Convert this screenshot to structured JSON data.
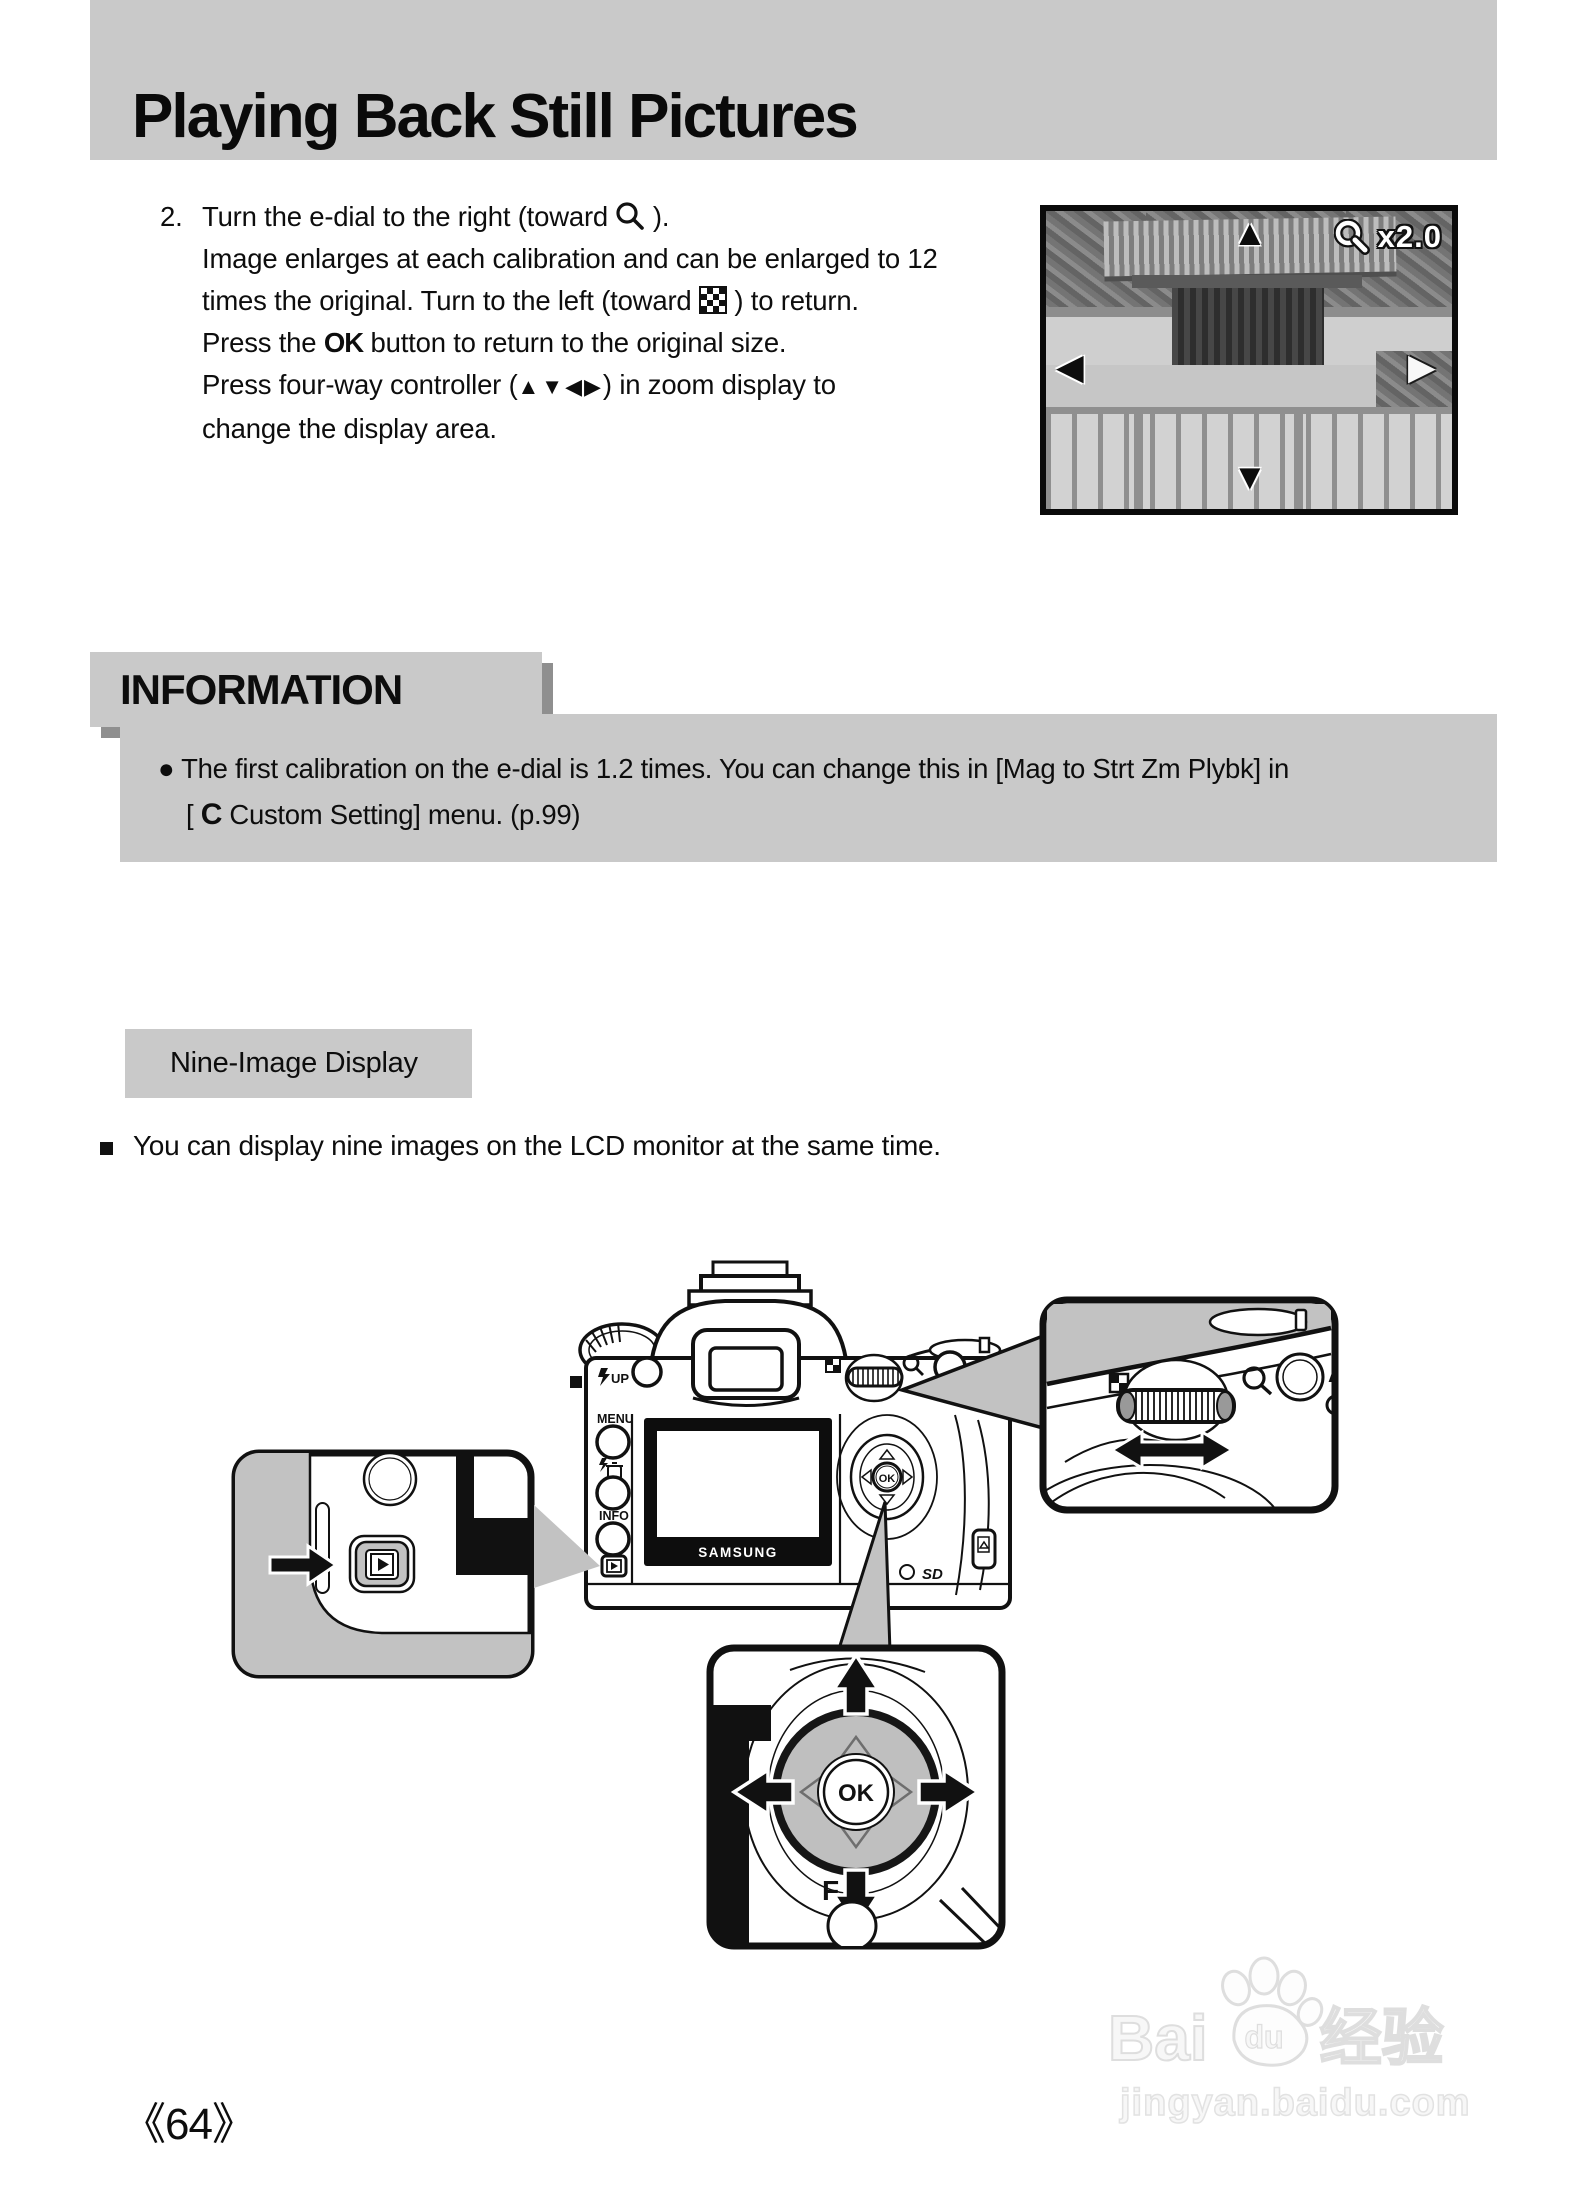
{
  "page": {
    "title": "Playing Back Still Pictures",
    "page_number": "《64》"
  },
  "instruction": {
    "number": "2.",
    "line1_pre": "Turn the e-dial to the right (toward",
    "line1_post": ").",
    "line2": "Image enlarges at each calibration and can be enlarged to 12",
    "line3_pre": "times the original. Turn to the left (toward",
    "line3_post": ") to return.",
    "line4_pre": "Press the",
    "line4_ok": "OK",
    "line4_post": "button to return to the original size.",
    "line5_pre": "Press four-way controller (",
    "line5_arrows": "▲▼◀▶",
    "line5_post": ") in zoom display to",
    "line6": "change the display area."
  },
  "lcd_preview": {
    "zoom_label": "x2.0",
    "arrow_up": "▲",
    "arrow_down": "▼",
    "arrow_left": "◀",
    "arrow_right": "▶"
  },
  "information": {
    "heading": "INFORMATION",
    "bullet": "●",
    "line1": "The first calibration on the e-dial is 1.2 times. You can change this in [Mag to Strt Zm Plybk] in",
    "line2_open": "[",
    "line2_c": "C",
    "line2_rest": "Custom Setting] menu. (p.99)"
  },
  "nine_image": {
    "label": "Nine-Image Display",
    "bullet_text": "You can display nine images on the LCD monitor at the same time."
  },
  "diagram": {
    "flash_up_label": "UP",
    "menu_label": "MENU",
    "info_label": "INFO",
    "ae_lock_label": "AE-L",
    "brand_label": "SAMSUNG",
    "ok_label": "OK",
    "ok_big_label": "OK",
    "sd_label": "SD",
    "fn_label": "F",
    "a_partial_label": "A"
  },
  "watermark": {
    "brand_left": "Bai",
    "brand_right": "du",
    "brand_cn": "经验",
    "site": "jingyan.baidu.com"
  }
}
